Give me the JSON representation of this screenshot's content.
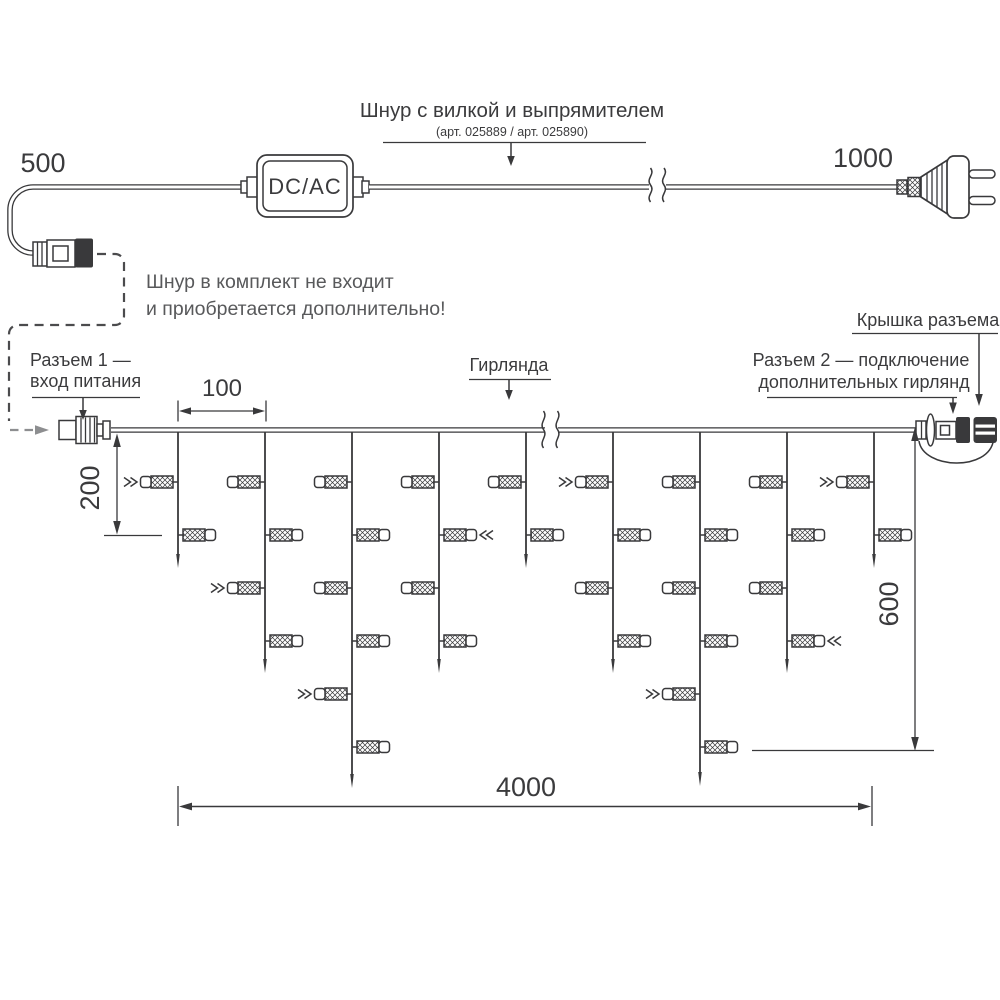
{
  "cord": {
    "dim_left": "500",
    "dim_right": "1000",
    "converter": "DC/AC",
    "title": "Шнур с вилкой и выпрямителем",
    "subtitle": "(арт. 025889 / арт. 025890)",
    "note1": "Шнур в комплект не входит",
    "note2": "и приобретается дополнительно!"
  },
  "garland": {
    "connector1_line1": "Разъем 1 —",
    "connector1_line2": "вход питания",
    "garland_label": "Гирлянда",
    "cap_label": "Крышка разъема",
    "connector2_line1": "Разъем 2 — подключение",
    "connector2_line2": "дополнительных гирлянд",
    "dim_spacing": "100",
    "dim_first_drop": "200",
    "dim_height": "600",
    "dim_length": "4000"
  },
  "colors": {
    "line": "#39393b",
    "text": "#3b3b3d",
    "gray_text": "#58595b",
    "gray_arrow": "#8d8e90"
  },
  "garland_layout": {
    "main_y": 430,
    "x_start": 111,
    "x_end": 916,
    "lamp_rows": [
      482,
      535,
      588,
      641,
      694,
      747
    ],
    "drops": [
      {
        "x": 178,
        "tip": 568,
        "lamps": 2,
        "markers": [
          0
        ]
      },
      {
        "x": 265,
        "tip": 673,
        "lamps": 4,
        "markers": [
          2
        ]
      },
      {
        "x": 352,
        "tip": 788,
        "lamps": 6,
        "markers": [
          4
        ]
      },
      {
        "x": 439,
        "tip": 673,
        "lamps": 4,
        "markers": [
          1
        ]
      },
      {
        "x": 526,
        "tip": 568,
        "lamps": 2,
        "markers": []
      },
      {
        "x": 613,
        "tip": 673,
        "lamps": 4,
        "markers": [
          0
        ]
      },
      {
        "x": 700,
        "tip": 786,
        "lamps": 6,
        "markers": [
          4
        ]
      },
      {
        "x": 787,
        "tip": 673,
        "lamps": 4,
        "markers": [
          3
        ]
      },
      {
        "x": 874,
        "tip": 568,
        "lamps": 2,
        "markers": [
          0
        ]
      }
    ]
  }
}
